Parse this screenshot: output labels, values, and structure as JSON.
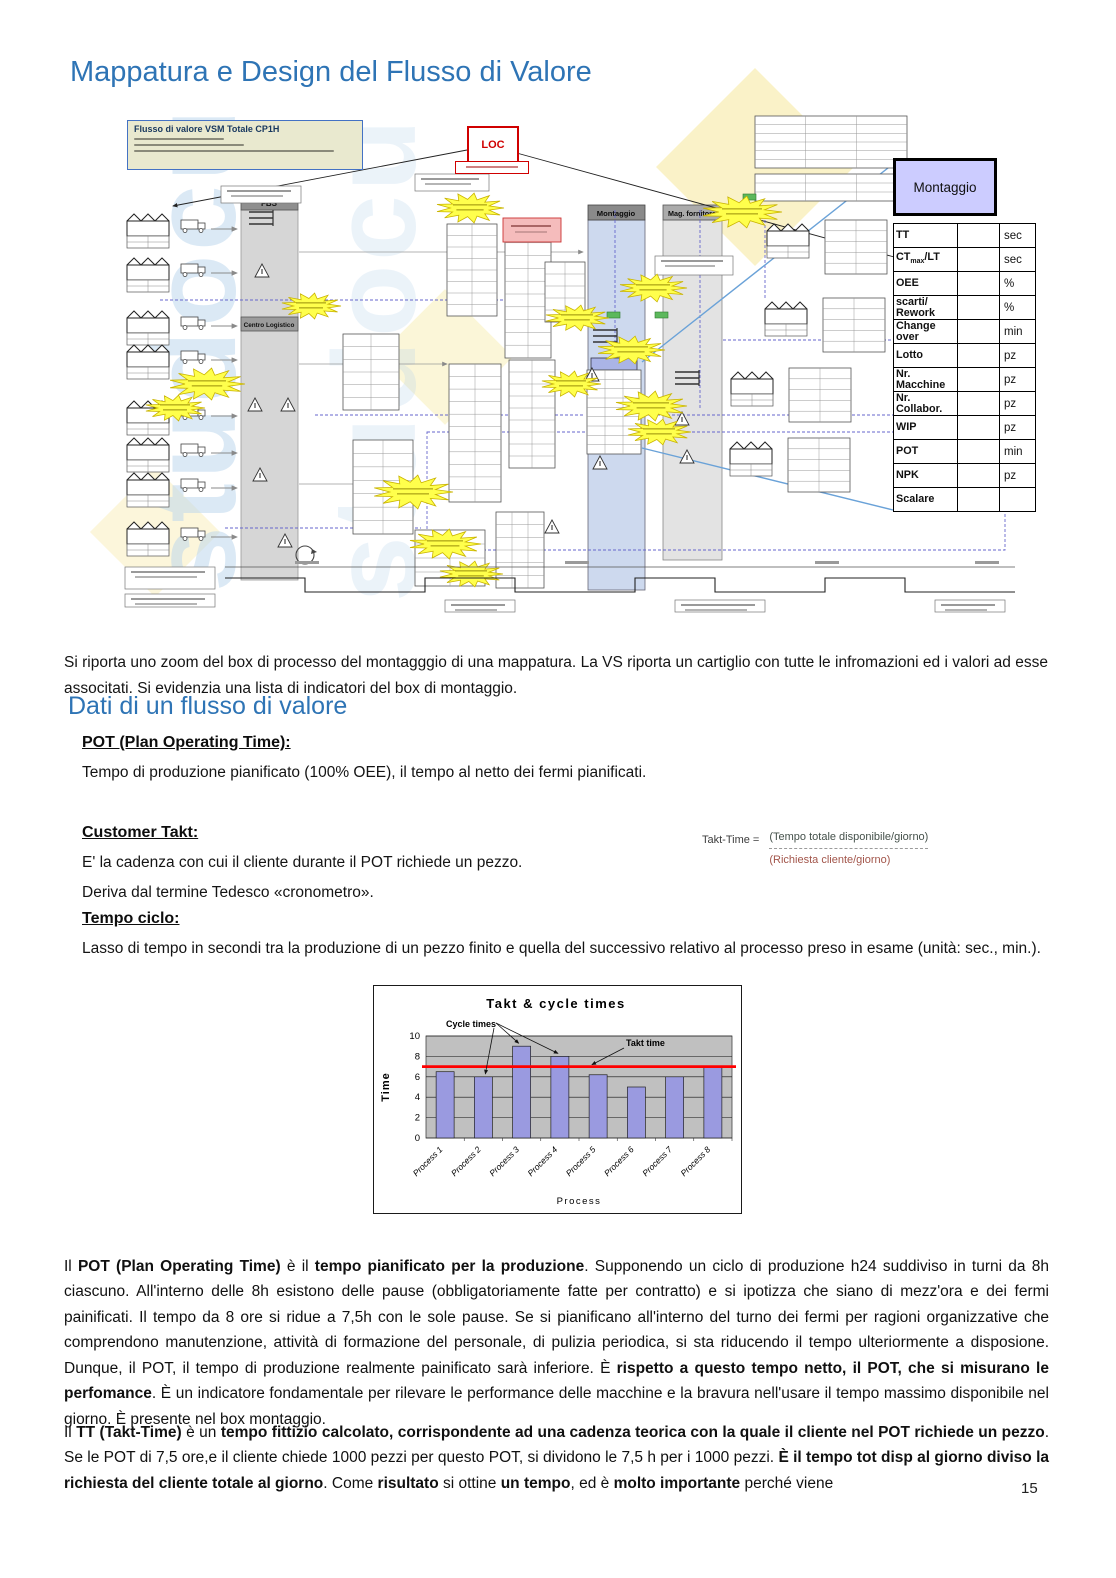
{
  "header": {
    "title": "Mappatura e Design del Flusso di Valore"
  },
  "page": {
    "number": "15"
  },
  "diagram": {
    "map_title": "Flusso di valore VSM Totale CP1H",
    "loc_label": "LOC",
    "fbs_label": "FBS",
    "centro_logistico_label": "Centro Logistico",
    "montaggio_col_label": "Montaggio",
    "mag_fornitore_label": "Mag. fornitore",
    "watermark_text": "studocu"
  },
  "cartiglio": {
    "title": "Montaggio",
    "rows": [
      {
        "pre": "TT",
        "sub": "",
        "post": "",
        "value": "",
        "unit": "sec"
      },
      {
        "pre": "CT",
        "sub": "max",
        "post": "/LT",
        "value": "",
        "unit": "sec"
      },
      {
        "pre": "OEE",
        "sub": "",
        "post": "",
        "value": "",
        "unit": "%"
      },
      {
        "pre": "scarti/ Rework",
        "sub": "",
        "post": "",
        "value": "",
        "unit": "%"
      },
      {
        "pre": "Change over",
        "sub": "",
        "post": "",
        "value": "",
        "unit": "min"
      },
      {
        "pre": "Lotto",
        "sub": "",
        "post": "",
        "value": "",
        "unit": "pz"
      },
      {
        "pre": "Nr. Macchine",
        "sub": "",
        "post": "",
        "value": "",
        "unit": "pz"
      },
      {
        "pre": "Nr. Collabor.",
        "sub": "",
        "post": "",
        "value": "",
        "unit": "pz"
      },
      {
        "pre": "WIP",
        "sub": "",
        "post": "",
        "value": "",
        "unit": "pz"
      },
      {
        "pre": "POT",
        "sub": "",
        "post": "",
        "value": "",
        "unit": "min"
      },
      {
        "pre": "NPK",
        "sub": "",
        "post": "",
        "value": "",
        "unit": "pz"
      },
      {
        "pre": "Scalare",
        "sub": "",
        "post": "",
        "value": "",
        "unit": ""
      }
    ]
  },
  "caption": "Si riporta uno zoom del box di processo del montagggio di una mappatura. La VS riporta un cartiglio con tutte le infromazioni ed i valori ad esse associtati. Si evidenzia una lista di indicatori del box di montaggio.",
  "section": {
    "heading": "Dati di un flusso di valore",
    "pot": {
      "heading": "POT (Plan Operating Time):",
      "body": "Tempo di produzione pianificato (100% OEE), il tempo al netto dei fermi pianificati."
    },
    "takt": {
      "heading": "Customer Takt:",
      "line1": "E' la cadenza con cui il cliente durante il POT richiede un pezzo.",
      "line2": "Deriva dal termine Tedesco «cronometro».",
      "formula": {
        "lhs": "Takt-Time =",
        "numerator": "(Tempo totale disponibile/giorno)",
        "denominator": "(Richiesta cliente/giorno)"
      }
    },
    "tempo_ciclo": {
      "heading": "Tempo ciclo:",
      "body": "Lasso di tempo in secondi tra la produzione di un pezzo finito e quella del successivo relativo al processo preso in esame (unità: sec., min.)."
    }
  },
  "chart_data": {
    "type": "bar",
    "title": "Takt & cycle times",
    "categories": [
      "Process 1",
      "Process 2",
      "Process 3",
      "Process 4",
      "Process 5",
      "Process 6",
      "Process 7",
      "Process 8"
    ],
    "values": [
      6.5,
      6,
      9,
      8,
      6.2,
      5,
      6,
      7
    ],
    "takt_value": 7,
    "takt_label": "Takt time",
    "series_label": "Cycle times",
    "xlabel": "Process",
    "ylabel": "Time",
    "ylim": [
      0,
      10
    ],
    "yticks": [
      0,
      2,
      4,
      6,
      8,
      10
    ],
    "bar_color": "#9a9ae0",
    "takt_color": "#ff0000",
    "plot_bg": "#c0c0c0",
    "grid": true,
    "legend_position": "none"
  },
  "paragraphs": {
    "pot_rich": [
      {
        "t": "Il ",
        "b": false
      },
      {
        "t": "POT (Plan Operating Time)",
        "b": true
      },
      {
        "t": " è il ",
        "b": false
      },
      {
        "t": "tempo pianificato per la produzione",
        "b": true
      },
      {
        "t": ". Supponendo un ciclo di produzione h24 suddiviso in turni da 8h ciascuno. All'interno delle 8h esistono delle pause (obbligatoriamente fatte per contratto) e si ipotizza che siano di mezz'ora e dei fermi painificati. Il tempo da 8 ore si ridue a 7,5h con le sole pause. Se si pianificano all'interno del turno dei fermi per ragioni organizzative che comprendono manutenzione, attività di formazione del personale, di pulizia periodica, si sta riducendo il tempo ulteriormente a disposione. Dunque, il POT, il tempo di produzione realmente painificato sarà inferiore. È ",
        "b": false
      },
      {
        "t": "rispetto a questo tempo netto, il POT, che si misurano le perfomance",
        "b": true
      },
      {
        "t": ". È un indicatore fondamentale per rilevare le performance delle macchine e la bravura nell'usare il tempo massimo disponibile nel giorno. È presente nel box montaggio.",
        "b": false
      }
    ],
    "tt_rich": [
      {
        "t": "Il ",
        "b": false
      },
      {
        "t": "TT (Takt-Time)",
        "b": true
      },
      {
        "t": " è un ",
        "b": false
      },
      {
        "t": "tempo fittizio calcolato, corrispondente ad una cadenza teorica con la quale il cliente nel POT richiede un pezzo",
        "b": true
      },
      {
        "t": ". Se le POT di 7,5 ore,e il cliente chiede 1000 pezzi per questo POT, si dividono le 7,5 h per i 1000 pezzi. ",
        "b": false
      },
      {
        "t": "È il tempo tot disp al giorno diviso la richiesta del cliente totale al giorno",
        "b": true
      },
      {
        "t": ". Come ",
        "b": false
      },
      {
        "t": "risultato",
        "b": true
      },
      {
        "t": " si ottine ",
        "b": false
      },
      {
        "t": "un tempo",
        "b": true
      },
      {
        "t": ", ed è ",
        "b": false
      },
      {
        "t": "molto importante",
        "b": true
      },
      {
        "t": " perché viene",
        "b": false
      }
    ]
  },
  "colors": {
    "heading_blue": "#2e74b5",
    "cartiglio_header_bg": "#ccccff",
    "takt_red": "#ff0000"
  }
}
